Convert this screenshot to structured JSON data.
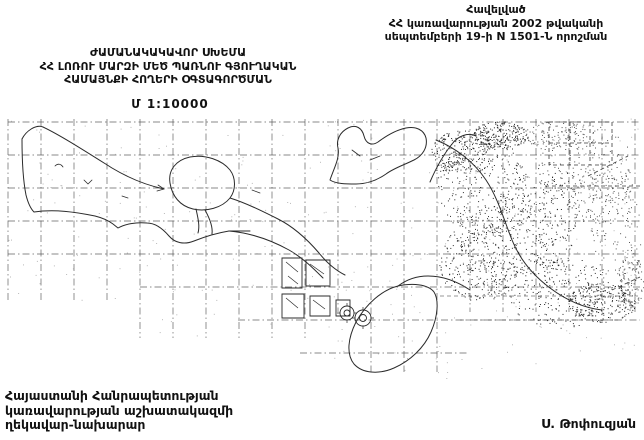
{
  "page": {
    "background": "#ffffff",
    "ink": "#111111"
  },
  "appendix": {
    "line1": "Հավելված",
    "line2": "ՀՀ կառավարության 2002 թվականի",
    "line3": "սեպտեմբերի 19-ի N 1501-Ն որոշման"
  },
  "title": {
    "line1": "ԺԱՄԱՆԱԿԱԿԱՎՈՐ ՍԽԵՄԱ",
    "line2": "ՀՀ ԼՈՌՈՒ ՄԱՐԶԻ ՄԵԾ ՊԱՌՆՈՒ ԳՅՈՒՂԱԿԱՆ",
    "line3": "ՀԱՄԱՅՆՔԻ ՀՈՂԵՐԻ ՕԳՏԱԳՈՐԾՄԱՆ",
    "scale": "Մ 1:10000"
  },
  "footer": {
    "office_line1": "Հայաստանի Հանրապետության",
    "office_line2": "կառավարության աշխատակազմի",
    "office_line3": "ղեկավար-նախարար",
    "signatory": "Ս. Թոփուզյան"
  },
  "map": {
    "kind": "scanned cadastral land-use scheme of Mets Parni rural community",
    "grid_color": "#4a4a4a",
    "ink_color": "#2b2b2b"
  }
}
